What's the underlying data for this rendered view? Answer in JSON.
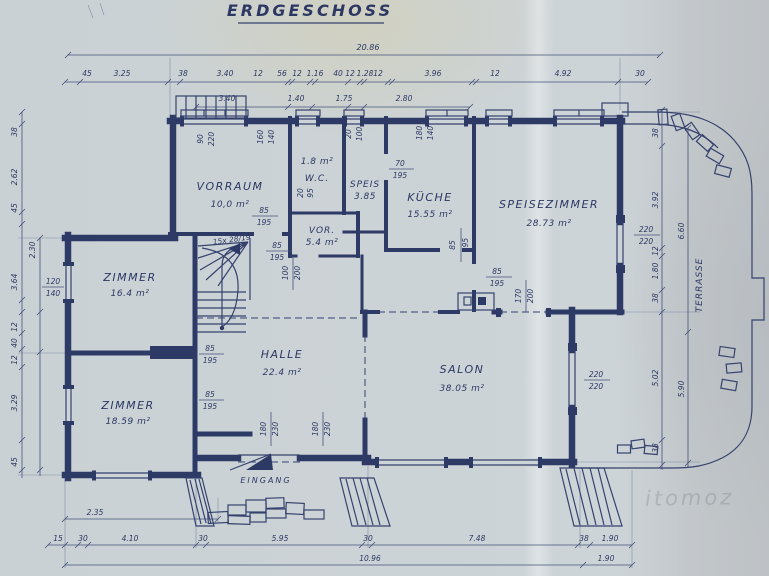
{
  "title": "ERDGESCHOSS",
  "watermark": "itomoz",
  "colors": {
    "ink": "#2e3a66",
    "paper": "#cdd4d8"
  },
  "rooms": [
    {
      "name": "VORRAUM",
      "area": "10,0 m²"
    },
    {
      "name": "W.C.",
      "area": "1.8 m²"
    },
    {
      "name": "SPEIS",
      "area": "3.85"
    },
    {
      "name": "VOR.",
      "area": "5.4 m²"
    },
    {
      "name": "KÜCHE",
      "area": "15.55 m²"
    },
    {
      "name": "SPEISEZIMMER",
      "area": "28.73 m²"
    },
    {
      "name": "ZIMMER",
      "area": "16.4 m²"
    },
    {
      "name": "ZIMMER",
      "area": "18.59 m²"
    },
    {
      "name": "HALLE",
      "area": "22.4 m²"
    },
    {
      "name": "SALON",
      "area": "38.05 m²"
    },
    {
      "name": "TERRASSE"
    },
    {
      "name": "EINGANG"
    }
  ],
  "stairs_label": "15x 28/19",
  "dims": {
    "top_total": "20.86",
    "top1": [
      "45",
      "3.25",
      "38",
      "3.40",
      "12",
      "56",
      "12",
      "1.16",
      "40",
      "12",
      "1.28",
      "12",
      "3.96",
      "12",
      "4.92",
      "30"
    ],
    "top2": [
      "3.40",
      "1.40",
      "1.75",
      "2.80"
    ],
    "left1": [
      "38",
      "2.62",
      "45",
      "3.64",
      "12",
      "40",
      "12",
      "3.29",
      "45"
    ],
    "left2": "2.30",
    "right1": [
      "38",
      "3.92",
      "12",
      "1.80",
      "38",
      "5.02",
      "38"
    ],
    "right2": [
      "6.60",
      "5.90"
    ],
    "bottom1": [
      "15",
      "30",
      "4.10",
      "30",
      "5.95",
      "30",
      "7.48",
      "38",
      "1.90"
    ],
    "bottom2": [
      "10.96",
      "1.90"
    ],
    "b235": "2.35",
    "pair_85_195": {
      "w": "85",
      "h": "195"
    },
    "pair_70_195": {
      "w": "70",
      "h": "195"
    },
    "pair_20_95": {
      "w": "20",
      "h": "95"
    },
    "pair_100_200": {
      "w": "100",
      "h": "200"
    },
    "pair_170_200": {
      "w": "170",
      "h": "200"
    },
    "pair_180_230": {
      "w": "180",
      "h": "230"
    },
    "pair_120_140": {
      "w": "120",
      "h": "140"
    },
    "pair_220": {
      "a": "220",
      "b": "220"
    },
    "win1": {
      "w": "90",
      "h": "220"
    },
    "win2": {
      "w": "160",
      "h": "140"
    },
    "win3": {
      "w": "20",
      "h": "100"
    },
    "win4": {
      "w": "180",
      "h": "140"
    }
  }
}
